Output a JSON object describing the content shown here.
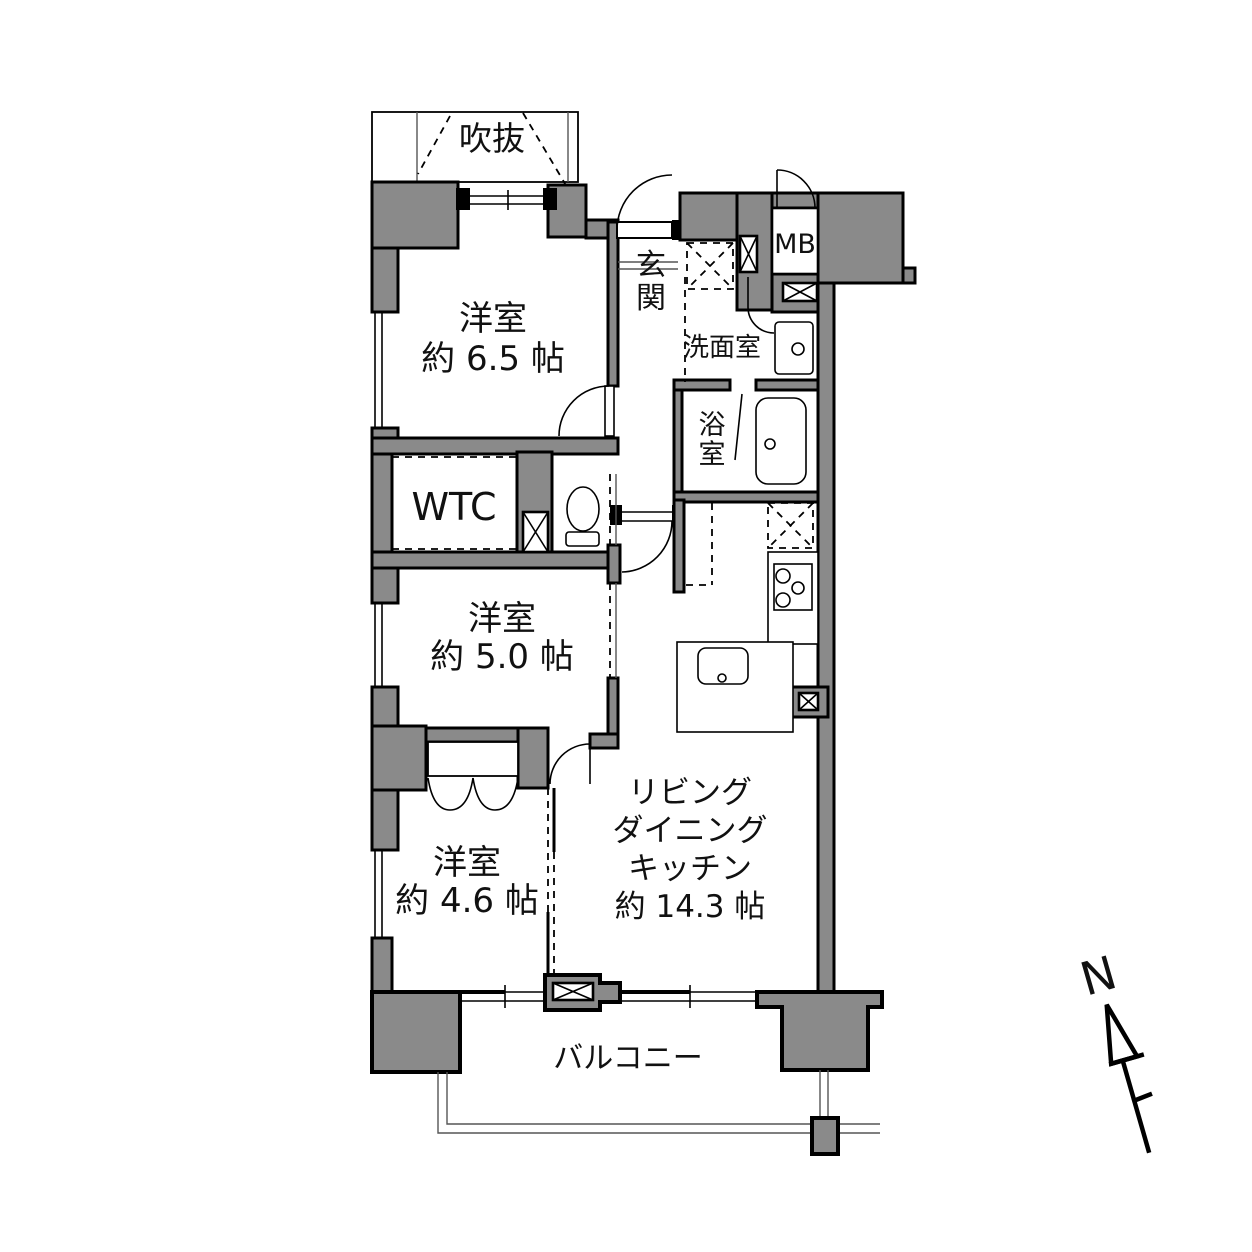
{
  "colors": {
    "wall_fill": "#8a8a8a",
    "line": "#000000",
    "background": "#ffffff"
  },
  "rooms": {
    "void_space": {
      "label": "吹抜"
    },
    "bedroom_65": {
      "name": "洋室",
      "size": "約 6.5 帖"
    },
    "entrance": {
      "label": "玄関"
    },
    "meter_box": {
      "label": "MB"
    },
    "washroom": {
      "label": "洗面室"
    },
    "bathroom": {
      "label": "浴室"
    },
    "wtc": {
      "label": "WTC"
    },
    "bedroom_50": {
      "name": "洋室",
      "size": "約 5.0 帖"
    },
    "bedroom_46": {
      "name": "洋室",
      "size": "約 4.6 帖"
    },
    "ldk": {
      "line1": "リビング",
      "line2": "ダイニング",
      "line3": "キッチン",
      "size": "約 14.3 帖"
    },
    "balcony": {
      "label": "バルコニー"
    }
  },
  "compass": {
    "label": "N"
  }
}
